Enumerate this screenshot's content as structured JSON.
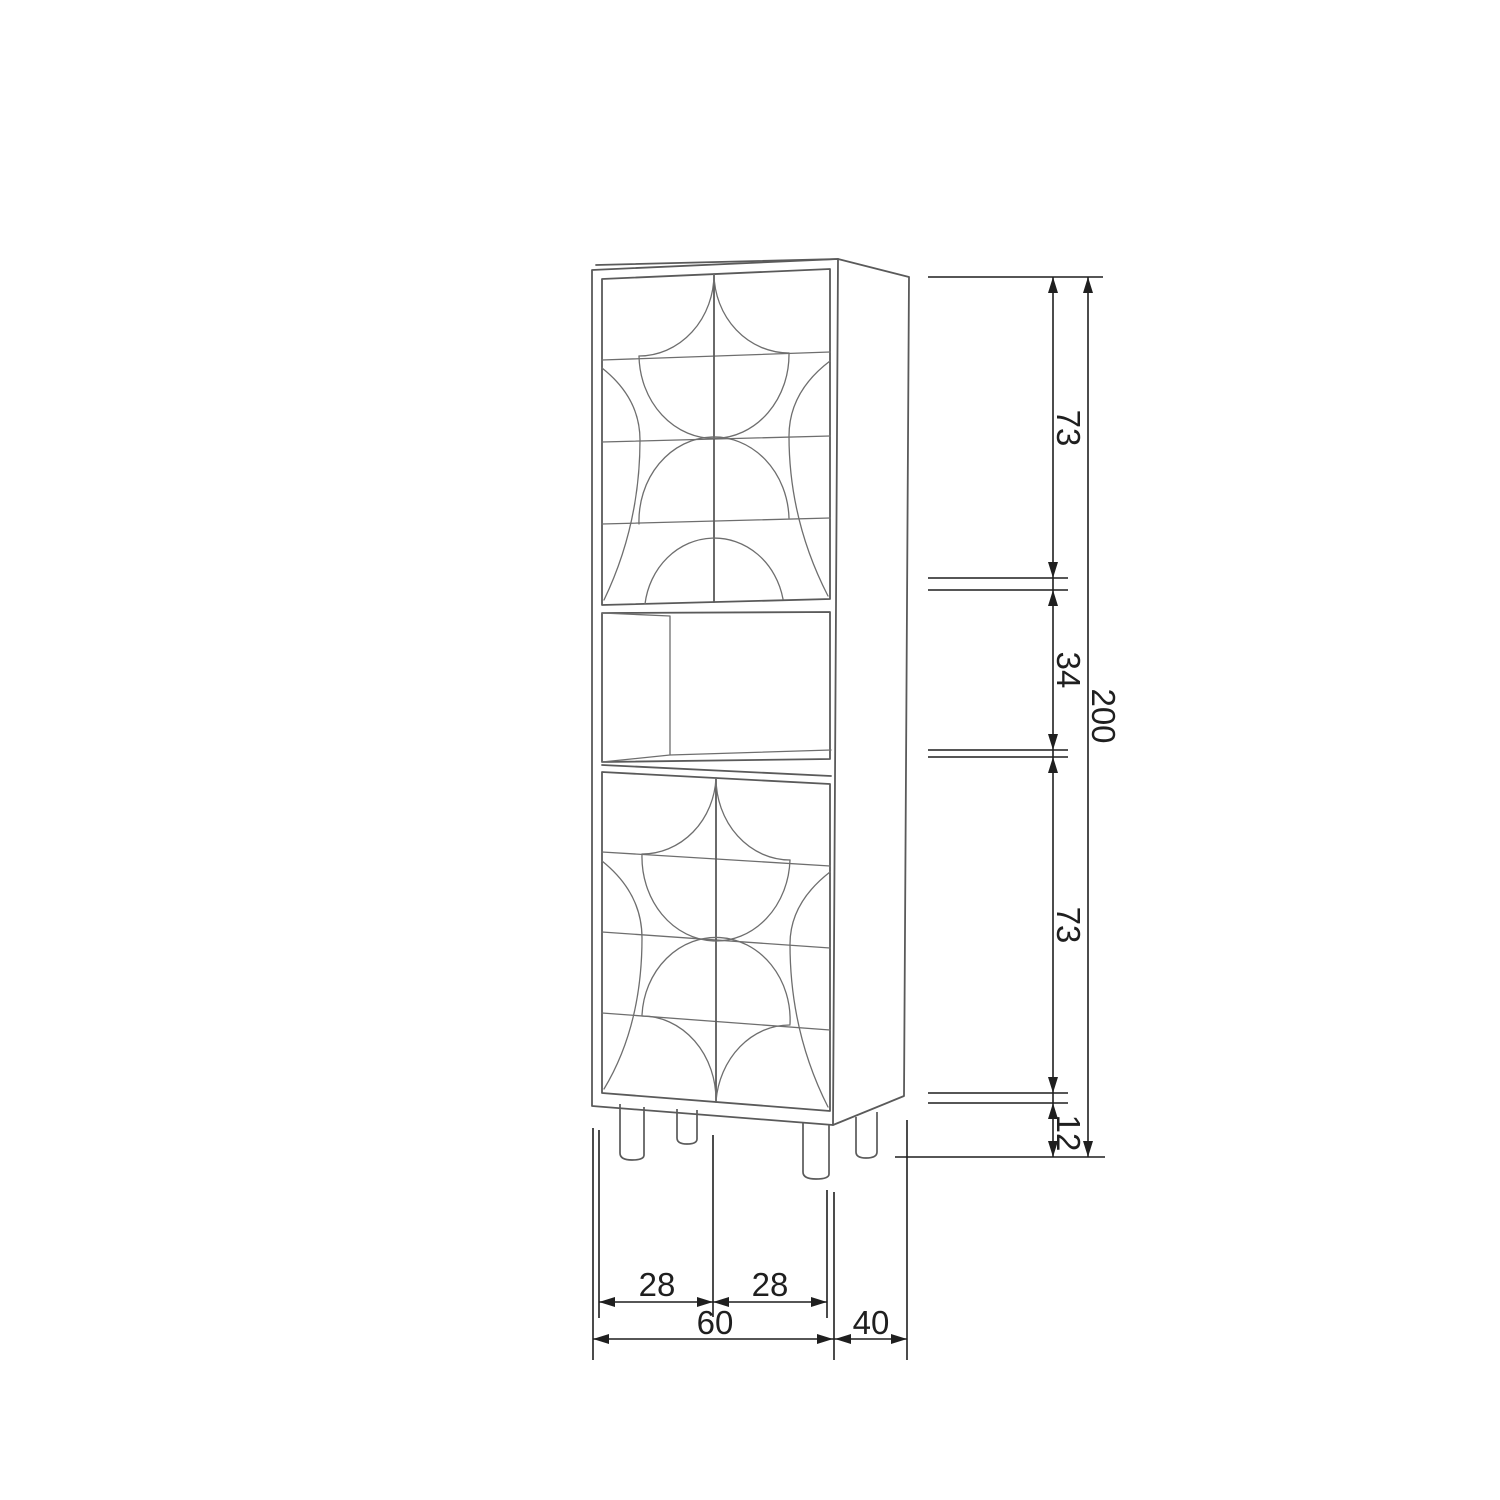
{
  "drawing": {
    "kind": "furniture-dimension-drawing",
    "subject": "tall-cabinet-with-patterned-doors-open-shelf-and-legs"
  },
  "colors": {
    "background": "#ffffff",
    "cabinet": "#5a5a5a",
    "pattern": "#6e6e6e",
    "dimension": "#1f1f1f"
  },
  "dims": {
    "right": [
      {
        "id": "upper-door-height",
        "label": "73"
      },
      {
        "id": "open-shelf-height",
        "label": "34"
      },
      {
        "id": "lower-door-height",
        "label": "73"
      },
      {
        "id": "leg-height",
        "label": "12"
      },
      {
        "id": "total-height",
        "label": "200"
      }
    ],
    "bottom": [
      {
        "id": "left-door-width",
        "label": "28"
      },
      {
        "id": "right-door-width",
        "label": "28"
      },
      {
        "id": "total-width",
        "label": "60"
      },
      {
        "id": "depth",
        "label": "40"
      }
    ]
  }
}
